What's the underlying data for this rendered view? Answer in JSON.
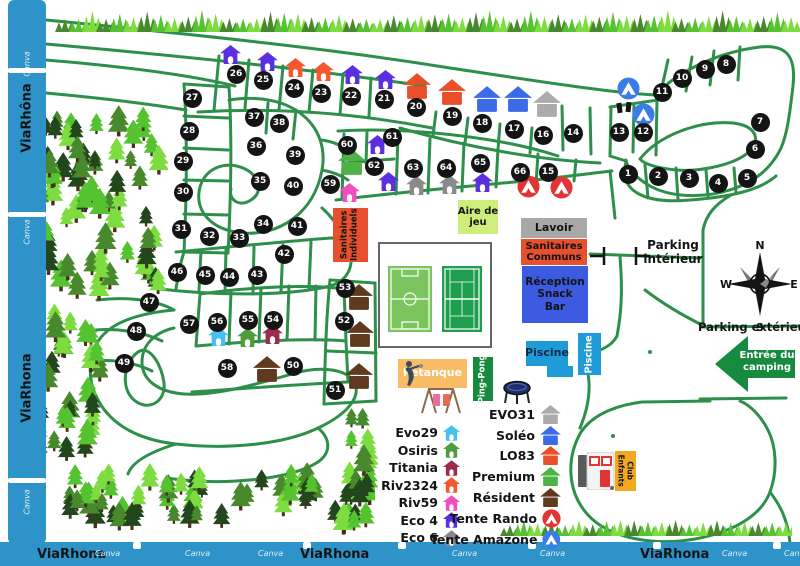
{
  "map": {
    "colors": {
      "road": "#2e8f4a",
      "strip": "#2d93c9",
      "black": "#141414",
      "tree_dark": "#23471c",
      "tree_mid": "#47892c",
      "tree_bright": "#55c22f",
      "tree_light": "#7ddc3f"
    },
    "borders": {
      "left_labels": [
        "ViaRhôna",
        "ViaRhona"
      ],
      "bottom_labels": [
        "ViaRhona",
        "ViaRhona",
        "ViaRhona"
      ],
      "watermark": "Canva"
    },
    "compass": {
      "north": "N",
      "east": "E",
      "south": "S",
      "west": "W"
    },
    "entrance": {
      "lines": [
        "Entrée du",
        "camping"
      ],
      "color": "#168a3e"
    },
    "areas": {
      "parking_interieur": {
        "lines": [
          "Parking",
          "intérieur"
        ]
      },
      "parking_exterieur": {
        "lines": [
          "Parking extérieur"
        ]
      }
    },
    "facilities": [
      {
        "id": "sanitaires-individuels",
        "lines": [
          "Sanitaires",
          "Individuels"
        ],
        "bg": "#e7502e",
        "fg": "#141414",
        "x": 333,
        "y": 208,
        "w": 35,
        "h": 54,
        "rot": -90,
        "fs": 8.5
      },
      {
        "id": "aire-de-jeu",
        "lines": [
          "Aire de",
          "jeu"
        ],
        "bg": "#cdee7a",
        "fg": "#141414",
        "x": 458,
        "y": 200,
        "w": 40,
        "h": 34,
        "rot": 0,
        "fs": 10
      },
      {
        "id": "lavoir",
        "lines": [
          "Lavoir"
        ],
        "bg": "#a8a8a8",
        "fg": "#141414",
        "x": 521,
        "y": 218,
        "w": 66,
        "h": 20,
        "rot": 0,
        "fs": 11
      },
      {
        "id": "sanitaires-communs",
        "lines": [
          "Sanitaires",
          "Communs"
        ],
        "bg": "#e7502e",
        "fg": "#141414",
        "x": 521,
        "y": 239,
        "w": 66,
        "h": 26,
        "rot": 0,
        "fs": 10
      },
      {
        "id": "reception-snack-bar",
        "lines": [
          "Réception",
          "Snack",
          "Bar"
        ],
        "bg": "#3d5be0",
        "fg": "#141414",
        "x": 522,
        "y": 266,
        "w": 66,
        "h": 57,
        "rot": 0,
        "fs": 10.5
      },
      {
        "id": "piscine",
        "lines": [
          "Piscine"
        ],
        "bg": "#1f9bd7",
        "fg": "#10294a",
        "x": 526,
        "y": 341,
        "w": 42,
        "h": 25,
        "rot": 0,
        "fs": 11
      },
      {
        "id": "piscine-2",
        "lines": [
          "Piscine"
        ],
        "bg": "#1f9bd7",
        "fg": "#ffffff",
        "x": 578,
        "y": 333,
        "w": 23,
        "h": 42,
        "rot": -90,
        "fs": 9.5
      },
      {
        "id": "petanque",
        "lines": [
          "Pétanque"
        ],
        "bg": "#f8bd66",
        "fg": "#ffffff",
        "x": 398,
        "y": 359,
        "w": 69,
        "h": 29,
        "rot": 0,
        "fs": 11
      },
      {
        "id": "ping-pong",
        "lines": [
          "Ping-Pong"
        ],
        "bg": "#168a3e",
        "fg": "#ffffff",
        "x": 473,
        "y": 357,
        "w": 20,
        "h": 44,
        "rot": -90,
        "fs": 8.5
      },
      {
        "id": "club-enfants",
        "lines": [
          "Club",
          "Enfants"
        ],
        "bg": "#f4a820",
        "fg": "#141414",
        "x": 615,
        "y": 451,
        "w": 21,
        "h": 40,
        "rot": 90,
        "fs": 7.5
      }
    ],
    "models": {
      "evo29": {
        "label": "Evo29",
        "color": "#45c0f0",
        "style": "small"
      },
      "osiris": {
        "label": "Osiris",
        "color": "#4f9c3c",
        "style": "small"
      },
      "titania": {
        "label": "Titania",
        "color": "#9c2a4a",
        "style": "small"
      },
      "riv2324": {
        "label": "Riv2324",
        "color": "#f4582c",
        "style": "small"
      },
      "riv59": {
        "label": "Riv59",
        "color": "#f04fc0",
        "style": "small"
      },
      "eco4": {
        "label": "Eco 4",
        "color": "#5b2ee0",
        "style": "small"
      },
      "eco6": {
        "label": "Eco 6",
        "color": "#8a8a8a",
        "style": "small"
      },
      "evo31": {
        "label": "EVO31",
        "color": "#ababab",
        "style": "large"
      },
      "soleo": {
        "label": "Soléo",
        "color": "#3a6ce8",
        "style": "large"
      },
      "lo83": {
        "label": "LO83",
        "color": "#ea4f2a",
        "style": "large"
      },
      "premium": {
        "label": "Premium",
        "color": "#4db344",
        "style": "large"
      },
      "resident": {
        "label": "Résident",
        "color": "#5f3a1e",
        "style": "large"
      },
      "tente-rando": {
        "label": "Tente Rando",
        "color": "#e23434",
        "style": "tent"
      },
      "tente-amazone": {
        "label": "Tente Amazone",
        "color": "#3a7de8",
        "style": "tent"
      }
    },
    "legend": {
      "left": [
        "evo29",
        "osiris",
        "titania",
        "riv2324",
        "riv59",
        "eco4",
        "eco6"
      ],
      "right": [
        "evo31",
        "soleo",
        "lo83",
        "premium",
        "resident",
        "tente-rando",
        "tente-amazone"
      ]
    },
    "pitches": [
      [
        1,
        628,
        174
      ],
      [
        2,
        658,
        176
      ],
      [
        3,
        689,
        178
      ],
      [
        4,
        718,
        183
      ],
      [
        5,
        747,
        178
      ],
      [
        6,
        755,
        149
      ],
      [
        7,
        760,
        122
      ],
      [
        8,
        726,
        64
      ],
      [
        9,
        705,
        69
      ],
      [
        10,
        682,
        78
      ],
      [
        11,
        662,
        92
      ],
      [
        12,
        643,
        132
      ],
      [
        13,
        619,
        132
      ],
      [
        14,
        573,
        133
      ],
      [
        15,
        548,
        172
      ],
      [
        16,
        543,
        135
      ],
      [
        17,
        514,
        129
      ],
      [
        18,
        482,
        123
      ],
      [
        19,
        452,
        116
      ],
      [
        20,
        416,
        107
      ],
      [
        21,
        384,
        99
      ],
      [
        22,
        351,
        96
      ],
      [
        23,
        321,
        93
      ],
      [
        24,
        294,
        88
      ],
      [
        25,
        263,
        80
      ],
      [
        26,
        236,
        74
      ],
      [
        27,
        192,
        98
      ],
      [
        28,
        189,
        131
      ],
      [
        29,
        183,
        161
      ],
      [
        30,
        183,
        192
      ],
      [
        31,
        181,
        229
      ],
      [
        32,
        209,
        236
      ],
      [
        33,
        239,
        238
      ],
      [
        34,
        263,
        224
      ],
      [
        35,
        260,
        181
      ],
      [
        36,
        256,
        146
      ],
      [
        37,
        254,
        117
      ],
      [
        38,
        279,
        123
      ],
      [
        39,
        295,
        155
      ],
      [
        40,
        293,
        186
      ],
      [
        41,
        297,
        226
      ],
      [
        42,
        284,
        254
      ],
      [
        43,
        257,
        275
      ],
      [
        44,
        229,
        277
      ],
      [
        45,
        205,
        275
      ],
      [
        46,
        177,
        272
      ],
      [
        47,
        149,
        302
      ],
      [
        48,
        136,
        331
      ],
      [
        49,
        124,
        363
      ],
      [
        50,
        293,
        366
      ],
      [
        51,
        335,
        390
      ],
      [
        52,
        344,
        321
      ],
      [
        53,
        345,
        288
      ],
      [
        54,
        273,
        320
      ],
      [
        55,
        248,
        320
      ],
      [
        56,
        217,
        322
      ],
      [
        57,
        189,
        324
      ],
      [
        58,
        227,
        368
      ],
      [
        59,
        330,
        184
      ],
      [
        60,
        347,
        145
      ],
      [
        61,
        392,
        137
      ],
      [
        62,
        374,
        166
      ],
      [
        63,
        413,
        168
      ],
      [
        64,
        446,
        168
      ],
      [
        65,
        480,
        163
      ],
      [
        66,
        520,
        172
      ]
    ],
    "houses": [
      [
        "eco4",
        230,
        54
      ],
      [
        "eco4",
        267,
        61
      ],
      [
        "eco4",
        352,
        74
      ],
      [
        "eco4",
        385,
        79
      ],
      [
        "eco4",
        377,
        144
      ],
      [
        "eco4",
        388,
        181
      ],
      [
        "eco4",
        482,
        182
      ],
      [
        "riv2324",
        295,
        67
      ],
      [
        "riv2324",
        323,
        71
      ],
      [
        "lo83",
        417,
        86
      ],
      [
        "lo83",
        452,
        92
      ],
      [
        "soleo",
        487,
        99
      ],
      [
        "soleo",
        518,
        99
      ],
      [
        "evo31",
        547,
        104
      ],
      [
        "premium",
        352,
        162
      ],
      [
        "riv59",
        349,
        192
      ],
      [
        "eco6",
        416,
        185
      ],
      [
        "eco6",
        449,
        184
      ],
      [
        "evo29",
        218,
        336
      ],
      [
        "osiris",
        247,
        337
      ],
      [
        "titania",
        272,
        334
      ],
      [
        "resident",
        359,
        297
      ],
      [
        "resident",
        360,
        334
      ],
      [
        "resident",
        267,
        369
      ],
      [
        "resident",
        359,
        376
      ]
    ],
    "tents": [
      [
        "tente-amazone",
        628,
        88
      ],
      [
        "tente-amazone",
        643,
        114
      ],
      [
        "tente-rando",
        528,
        186
      ],
      [
        "tente-rando",
        561,
        187
      ]
    ]
  }
}
